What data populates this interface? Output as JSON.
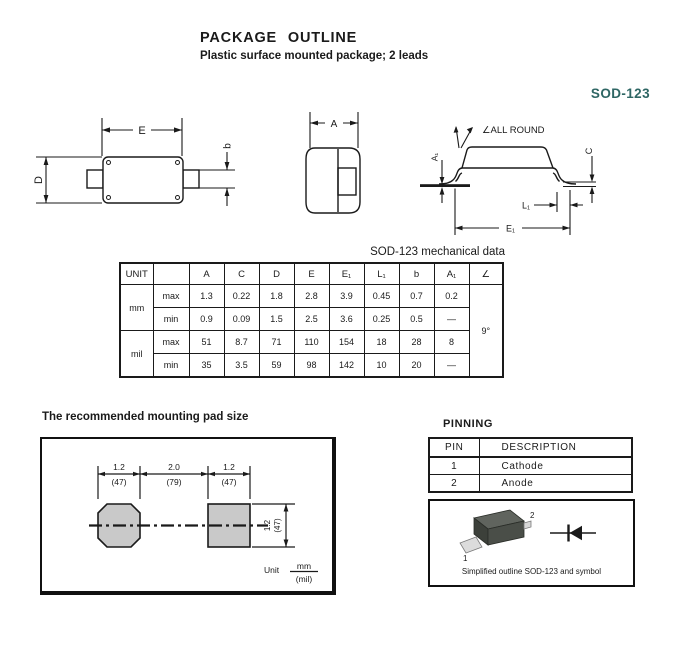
{
  "header": {
    "title": "PACKAGE OUTLINE",
    "subtitle": "Plastic surface mounted package; 2 leads",
    "package_name": "SOD-123"
  },
  "colors": {
    "accent_teal": "#2e6664",
    "pad_gray": "#c9c9c9",
    "line": "#1a1a1a"
  },
  "drawings": {
    "top_view": {
      "dim_e": "E",
      "dim_d": "D",
      "dim_b": "b"
    },
    "end_view": {
      "dim_a": "A"
    },
    "side_view": {
      "angle_note": "∠ALL ROUND",
      "dim_a1": "A₁",
      "dim_c": "C",
      "dim_l1": "L₁",
      "dim_e1": "E₁"
    }
  },
  "mech_table": {
    "title": "SOD-123 mechanical data",
    "headers": {
      "unit": "UNIT",
      "bound": "",
      "a": "A",
      "c": "C",
      "d": "D",
      "e": "E",
      "e1": "E₁",
      "l1": "L₁",
      "b": "b",
      "a1": "A₁",
      "angle": "∠"
    },
    "units": {
      "mm": "mm",
      "mil": "mil"
    },
    "bounds": {
      "max": "max",
      "min": "min"
    },
    "rows": {
      "mm_max": [
        "1.3",
        "0.22",
        "1.8",
        "2.8",
        "3.9",
        "0.45",
        "0.7",
        "0.2"
      ],
      "mm_min": [
        "0.9",
        "0.09",
        "1.5",
        "2.5",
        "3.6",
        "0.25",
        "0.5",
        "—"
      ],
      "mil_max": [
        "51",
        "8.7",
        "71",
        "110",
        "154",
        "18",
        "28",
        "8"
      ],
      "mil_min": [
        "35",
        "3.5",
        "59",
        "98",
        "142",
        "10",
        "20",
        "—"
      ]
    },
    "angle_value": "9°"
  },
  "mounting_pad": {
    "title": "The recommended mounting pad size",
    "dim_left_mm": "1.2",
    "dim_left_mil": "(47)",
    "dim_center_mm": "2.0",
    "dim_center_mil": "(79)",
    "dim_right_mm": "1.2",
    "dim_right_mil": "(47)",
    "dim_height_mm": "1.2",
    "dim_height_mil": "(47)",
    "unit_label": "Unit",
    "unit_numerator": "mm",
    "unit_denominator": "(mil)"
  },
  "pinning": {
    "title": "PINNING",
    "pin_header": "PIN",
    "desc_header": "DESCRIPTION",
    "rows": [
      {
        "pin": "1",
        "desc": "Cathode"
      },
      {
        "pin": "2",
        "desc": "Anode"
      }
    ]
  },
  "outline_box": {
    "pin1": "1",
    "pin2": "2",
    "caption": "Simplified outline SOD-123 and symbol"
  }
}
